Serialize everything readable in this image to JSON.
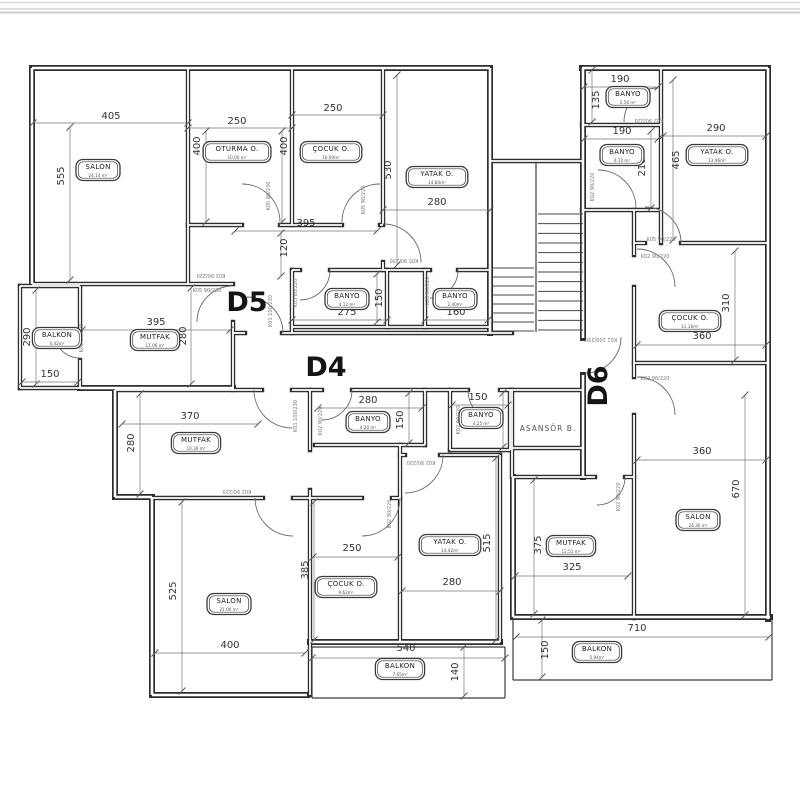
{
  "sheet": {
    "background": "#ffffff",
    "line_color": "#2e2e2e",
    "top_band_color": "#c9c9c9"
  },
  "units": [
    {
      "label": "D5",
      "x": 247,
      "y": 311,
      "rot": 0
    },
    {
      "label": "D4",
      "x": 326,
      "y": 376,
      "rot": 0
    },
    {
      "label": "D6",
      "x": 607,
      "y": 386,
      "rot": -90
    }
  ],
  "rooms": [
    {
      "name": "SALON",
      "area": "24.14 m²",
      "x": 98,
      "y": 170
    },
    {
      "name": "OTURMA O.",
      "area": "10.00 m²",
      "x": 237,
      "y": 152
    },
    {
      "name": "ÇOCUK O.",
      "area": "10.00m²",
      "x": 331,
      "y": 152
    },
    {
      "name": "YATAK O.",
      "area": "14.84m²",
      "x": 437,
      "y": 177
    },
    {
      "name": "BANYO",
      "area": "4.12 m²",
      "x": 347,
      "y": 299
    },
    {
      "name": "BANYO",
      "area": "2.40m²",
      "x": 455,
      "y": 299
    },
    {
      "name": "MUTFAK",
      "area": "11.06 m²",
      "x": 155,
      "y": 340
    },
    {
      "name": "BALKON",
      "area": "4.42m²",
      "x": 57,
      "y": 338
    },
    {
      "name": "MUTFAK",
      "area": "10.36 m²",
      "x": 196,
      "y": 443
    },
    {
      "name": "BANYO",
      "area": "4.20 m²",
      "x": 368,
      "y": 422
    },
    {
      "name": "BANYO",
      "area": "4.25 m²",
      "x": 481,
      "y": 418
    },
    {
      "name": "SALON",
      "area": "21.00 m²",
      "x": 229,
      "y": 604
    },
    {
      "name": "ÇOCUK O.",
      "area": "9.62m²",
      "x": 346,
      "y": 587
    },
    {
      "name": "YATAK O.",
      "area": "14.42m²",
      "x": 450,
      "y": 545
    },
    {
      "name": "BALKON",
      "area": "7.65m²",
      "x": 400,
      "y": 669
    },
    {
      "name": "BANYO",
      "area": "2.56 m²",
      "x": 628,
      "y": 97
    },
    {
      "name": "BANYO",
      "area": "4.10 m²",
      "x": 622,
      "y": 155
    },
    {
      "name": "YATAK O.",
      "area": "13.96m²",
      "x": 717,
      "y": 155
    },
    {
      "name": "ÇOCUK O.",
      "area": "11.16m²",
      "x": 690,
      "y": 321
    },
    {
      "name": "SALON",
      "area": "24.30 m²",
      "x": 698,
      "y": 520
    },
    {
      "name": "MUTFAK",
      "area": "12.51 m²",
      "x": 571,
      "y": 546
    },
    {
      "name": "BALKON",
      "area": "5.94m²",
      "x": 597,
      "y": 652
    }
  ],
  "dimensions": [
    {
      "t": "405",
      "x": 111,
      "y": 119,
      "r": 0,
      "l": [
        33,
        123,
        188,
        123
      ]
    },
    {
      "t": "555",
      "x": 64,
      "y": 176,
      "r": -90,
      "l": [
        70,
        127,
        70,
        280
      ]
    },
    {
      "t": "250",
      "x": 237,
      "y": 124,
      "r": 0,
      "l": [
        188,
        128,
        292,
        128
      ]
    },
    {
      "t": "400",
      "x": 200,
      "y": 146,
      "r": -90,
      "l": [
        206,
        131,
        206,
        222
      ]
    },
    {
      "t": "400",
      "x": 287,
      "y": 146,
      "r": -90,
      "l": [
        282,
        131,
        282,
        222
      ]
    },
    {
      "t": "250",
      "x": 333,
      "y": 111,
      "r": 0,
      "l": [
        292,
        115,
        383,
        115
      ]
    },
    {
      "t": "530",
      "x": 391,
      "y": 170,
      "r": -90,
      "l": [
        397,
        75,
        397,
        265
      ]
    },
    {
      "t": "280",
      "x": 437,
      "y": 205,
      "r": 0,
      "l": [
        383,
        210,
        490,
        210
      ]
    },
    {
      "t": "395",
      "x": 306,
      "y": 226,
      "r": 0,
      "l": [
        235,
        231,
        377,
        231
      ]
    },
    {
      "t": "120",
      "x": 287,
      "y": 248,
      "r": -90,
      "l": [
        281,
        233,
        281,
        276
      ]
    },
    {
      "t": "275",
      "x": 347,
      "y": 315,
      "r": 0,
      "l": [
        292,
        320,
        387,
        320
      ]
    },
    {
      "t": "150",
      "x": 382,
      "y": 298,
      "r": -90,
      "l": [
        377,
        274,
        377,
        322
      ]
    },
    {
      "t": "160",
      "x": 456,
      "y": 315,
      "r": 0,
      "l": [
        425,
        320,
        488,
        320
      ]
    },
    {
      "t": "395",
      "x": 156,
      "y": 325,
      "r": 0,
      "l": [
        82,
        330,
        230,
        330
      ]
    },
    {
      "t": "280",
      "x": 186,
      "y": 336,
      "r": -90,
      "l": [
        191,
        288,
        191,
        384
      ]
    },
    {
      "t": "290",
      "x": 30,
      "y": 337,
      "r": -90,
      "l": [
        36,
        290,
        36,
        384
      ]
    },
    {
      "t": "150",
      "x": 50,
      "y": 377,
      "r": 0,
      "l": [
        22,
        382,
        78,
        382
      ]
    },
    {
      "t": "370",
      "x": 190,
      "y": 419,
      "r": 0,
      "l": [
        122,
        424,
        258,
        424
      ]
    },
    {
      "t": "280",
      "x": 134,
      "y": 443,
      "r": -90,
      "l": [
        140,
        394,
        140,
        494
      ]
    },
    {
      "t": "280",
      "x": 368,
      "y": 403,
      "r": 0,
      "l": [
        318,
        408,
        422,
        408
      ]
    },
    {
      "t": "150",
      "x": 403,
      "y": 420,
      "r": -90,
      "l": [
        409,
        393,
        409,
        443
      ]
    },
    {
      "t": "150",
      "x": 478,
      "y": 400,
      "r": 0,
      "l": [
        452,
        405,
        508,
        405
      ]
    },
    {
      "t": "150",
      "x": 497,
      "y": 418,
      "r": -90,
      "l": [
        503,
        393,
        503,
        447
      ]
    },
    {
      "t": "525",
      "x": 176,
      "y": 591,
      "r": -90,
      "l": [
        182,
        502,
        182,
        691
      ]
    },
    {
      "t": "400",
      "x": 230,
      "y": 648,
      "r": 0,
      "l": [
        155,
        653,
        305,
        653
      ]
    },
    {
      "t": "250",
      "x": 352,
      "y": 551,
      "r": 0,
      "l": [
        313,
        557,
        398,
        557
      ]
    },
    {
      "t": "385",
      "x": 308,
      "y": 570,
      "r": -90,
      "l": [
        314,
        502,
        314,
        640
      ]
    },
    {
      "t": "515",
      "x": 490,
      "y": 543,
      "r": -90,
      "l": [
        496,
        458,
        496,
        640
      ]
    },
    {
      "t": "280",
      "x": 452,
      "y": 585,
      "r": 0,
      "l": [
        402,
        591,
        500,
        591
      ]
    },
    {
      "t": "540",
      "x": 406,
      "y": 651,
      "r": 0,
      "l": [
        312,
        658,
        505,
        658
      ]
    },
    {
      "t": "140",
      "x": 458,
      "y": 672,
      "r": -90,
      "l": [
        464,
        647,
        464,
        696
      ]
    },
    {
      "t": "190",
      "x": 620,
      "y": 82,
      "r": 0,
      "l": [
        584,
        87,
        658,
        87
      ]
    },
    {
      "t": "135",
      "x": 599,
      "y": 100,
      "r": -90,
      "l": [
        592,
        70,
        592,
        122
      ]
    },
    {
      "t": "190",
      "x": 622,
      "y": 134,
      "r": 0,
      "l": [
        584,
        139,
        658,
        139
      ]
    },
    {
      "t": "210",
      "x": 645,
      "y": 167,
      "r": -90,
      "l": [
        651,
        131,
        651,
        208
      ]
    },
    {
      "t": "290",
      "x": 716,
      "y": 131,
      "r": 0,
      "l": [
        663,
        136,
        766,
        136
      ]
    },
    {
      "t": "465",
      "x": 679,
      "y": 160,
      "r": -90,
      "l": [
        673,
        80,
        673,
        240
      ]
    },
    {
      "t": "310",
      "x": 729,
      "y": 303,
      "r": -90,
      "l": [
        735,
        251,
        735,
        360
      ]
    },
    {
      "t": "360",
      "x": 702,
      "y": 339,
      "r": 0,
      "l": [
        637,
        345,
        766,
        345
      ]
    },
    {
      "t": "360",
      "x": 702,
      "y": 454,
      "r": 0,
      "l": [
        637,
        460,
        766,
        460
      ]
    },
    {
      "t": "670",
      "x": 739,
      "y": 489,
      "r": -90,
      "l": [
        745,
        395,
        745,
        615
      ]
    },
    {
      "t": "375",
      "x": 541,
      "y": 545,
      "r": -90,
      "l": [
        534,
        480,
        534,
        614
      ]
    },
    {
      "t": "325",
      "x": 572,
      "y": 570,
      "r": 0,
      "l": [
        515,
        576,
        628,
        576
      ]
    },
    {
      "t": "710",
      "x": 637,
      "y": 631,
      "r": 0,
      "l": [
        516,
        637,
        769,
        637
      ]
    },
    {
      "t": "150",
      "x": 548,
      "y": 650,
      "r": -90,
      "l": [
        542,
        620,
        542,
        677
      ]
    }
  ],
  "door_labels": [
    {
      "t": "K05 80/230",
      "x": 270,
      "y": 196,
      "r": -90
    },
    {
      "t": "K05 90/220",
      "x": 365,
      "y": 200,
      "r": -90
    },
    {
      "t": "K05 90/230",
      "x": 404,
      "y": 259,
      "r": 180
    },
    {
      "t": "K02 90/220",
      "x": 211,
      "y": 274,
      "r": 180
    },
    {
      "t": "K05 90/230",
      "x": 207,
      "y": 292,
      "r": 0
    },
    {
      "t": "K01 100/230",
      "x": 272,
      "y": 311,
      "r": -90
    },
    {
      "t": "K03 80/220",
      "x": 297,
      "y": 293,
      "r": -90
    },
    {
      "t": "K03 80/220",
      "x": 429,
      "y": 291,
      "r": -90
    },
    {
      "t": "K02 90/220",
      "x": 83,
      "y": 338,
      "r": -90
    },
    {
      "t": "K01 100/230",
      "x": 297,
      "y": 416,
      "r": -90
    },
    {
      "t": "K02 90/220",
      "x": 322,
      "y": 421,
      "r": -90
    },
    {
      "t": "K02 90/220",
      "x": 460,
      "y": 420,
      "r": -90
    },
    {
      "t": "K02 90/220",
      "x": 421,
      "y": 461,
      "r": 180
    },
    {
      "t": "K02 90/220",
      "x": 237,
      "y": 490,
      "r": 180
    },
    {
      "t": "K02 90/220",
      "x": 391,
      "y": 514,
      "r": -90
    },
    {
      "t": "K02 90/220",
      "x": 649,
      "y": 119,
      "r": 180
    },
    {
      "t": "K02 90/220",
      "x": 594,
      "y": 187,
      "r": -90
    },
    {
      "t": "K05 90/220",
      "x": 661,
      "y": 241,
      "r": 0
    },
    {
      "t": "K02 90/220",
      "x": 655,
      "y": 258,
      "r": 0
    },
    {
      "t": "K02 90/220",
      "x": 655,
      "y": 380,
      "r": 0
    },
    {
      "t": "K01 100/230",
      "x": 601,
      "y": 338,
      "r": 180
    },
    {
      "t": "K02 90/220",
      "x": 620,
      "y": 497,
      "r": -90
    }
  ],
  "elevator_label": {
    "text": "ASANSÖR B.",
    "x": 548,
    "y": 431
  }
}
